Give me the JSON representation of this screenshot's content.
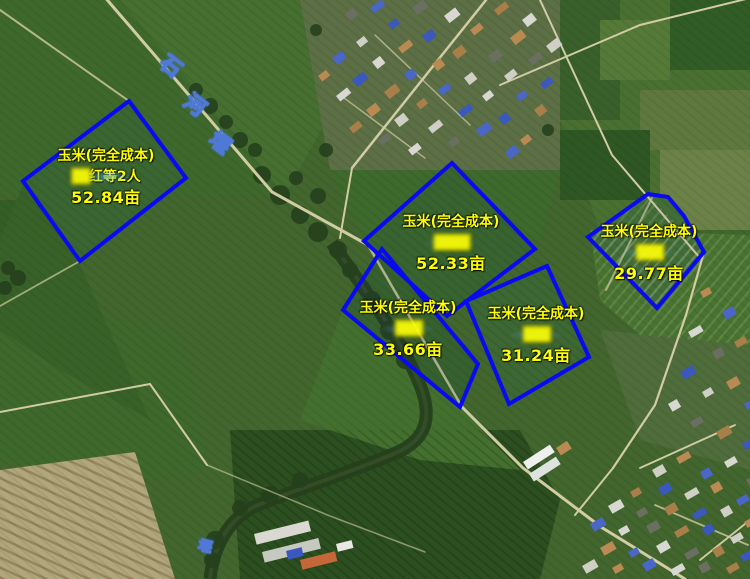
{
  "map": {
    "bg_color": "#42662e",
    "parcel_outline_color": "#0a0af2",
    "label_text_color": "#ffff00",
    "road_label_color": "#fbfdff",
    "road_label_outline_color": "#4f79d4"
  },
  "road_labels": {
    "river_name": {
      "text": "石河堰",
      "rotation": 38,
      "chars": [
        {
          "ch": "石",
          "x": 160,
          "y": 56
        },
        {
          "ch": "河",
          "x": 184,
          "y": 95
        },
        {
          "ch": "堰",
          "x": 209,
          "y": 133
        }
      ]
    },
    "bottom_label": {
      "text": "堰",
      "x": 198,
      "y": 540,
      "rotation": 14
    }
  },
  "parcels": [
    {
      "id": "parcel-1",
      "crop": "玉米(完全成本)",
      "owner_masked": "██",
      "owner_visible": "红等2人",
      "area": "52.84亩",
      "label_cx": 106,
      "label_top": 145,
      "points": "129,101 186,178 80,261 23,181"
    },
    {
      "id": "parcel-2",
      "crop": "玉米(完全成本)",
      "owner_masked": "████",
      "owner_visible": "",
      "area": "52.33亩",
      "label_cx": 451,
      "label_top": 211,
      "points": "452,163 535,249 447,316 364,241"
    },
    {
      "id": "parcel-3",
      "crop": "玉米(完全成本)",
      "owner_masked": "███",
      "owner_visible": "",
      "area": "33.66亩",
      "label_cx": 408,
      "label_top": 297,
      "points": "382,249 478,364 460,407 343,310"
    },
    {
      "id": "parcel-4",
      "crop": "玉米(完全成本)",
      "owner_masked": "███",
      "owner_visible": "",
      "area": "31.24亩",
      "label_cx": 536,
      "label_top": 303,
      "points": "547,266 589,357 509,404 466,301"
    },
    {
      "id": "parcel-5",
      "crop": "玉米(完全成本)",
      "owner_masked": "███",
      "owner_visible": "",
      "area": "29.77亩",
      "label_cx": 649,
      "label_top": 221,
      "points": "588,237 648,194 668,197 684,216 704,252 657,308"
    }
  ]
}
